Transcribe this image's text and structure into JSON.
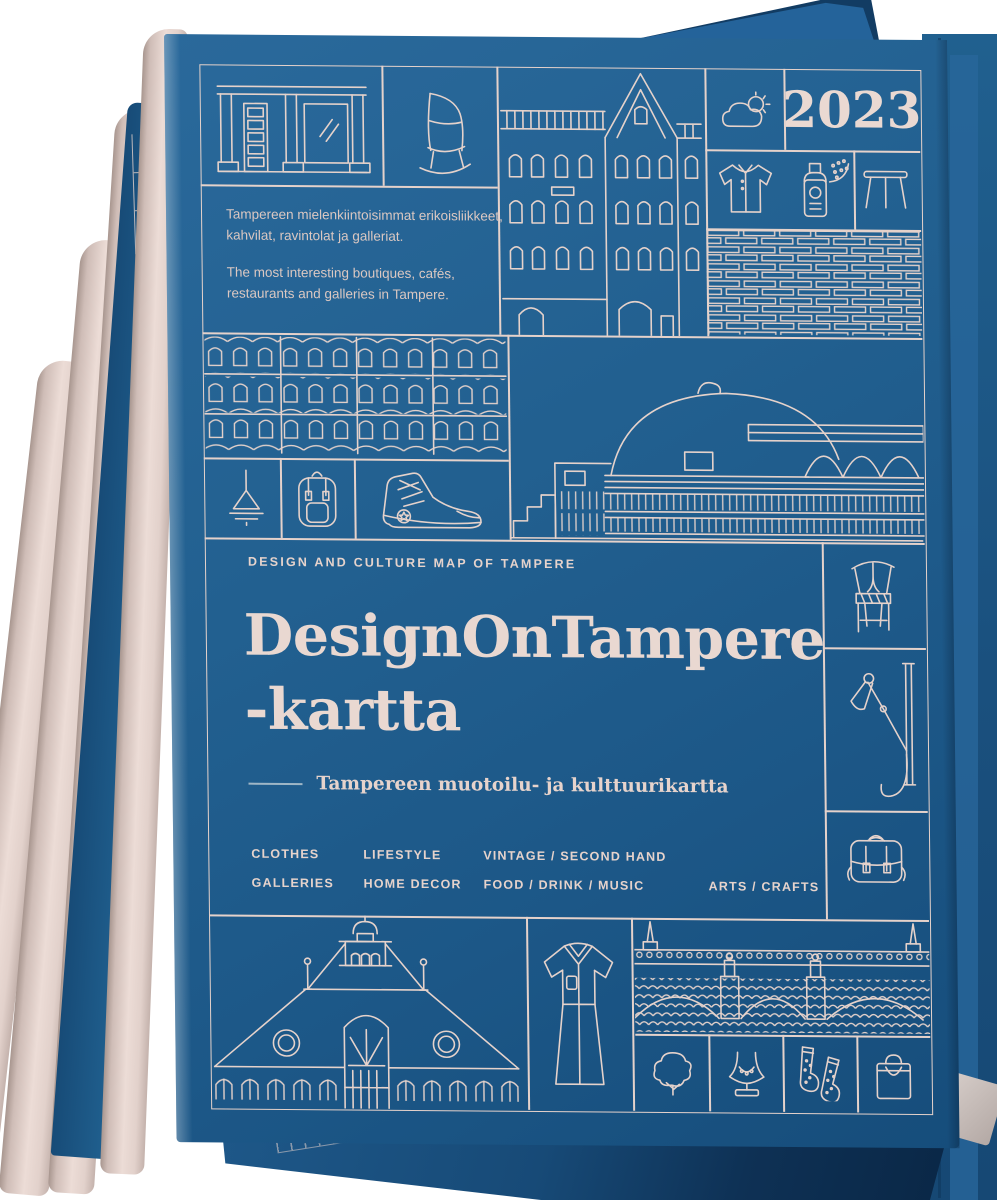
{
  "cover": {
    "year": "2023",
    "intro": {
      "fi": [
        "Tampereen mielenkiintoisimmat erikoisliikkeet,",
        "kahvilat, ravintolat ja galleriat."
      ],
      "en": [
        "The most interesting boutiques, cafés,",
        "restaurants and galleries in Tampere."
      ]
    },
    "masthead": {
      "eyebrow": "DESIGN AND CULTURE MAP OF TAMPERE",
      "title_line1": "DesignOnTampere",
      "title_line2": "-kartta",
      "subtitle": "Tampereen muotoilu- ja kulttuurikartta"
    },
    "categories": {
      "row1": [
        "CLOTHES",
        "LIFESTYLE",
        "VINTAGE / SECOND HAND"
      ],
      "row2": [
        "GALLERIES",
        "HOME DECOR",
        "FOOD / DRINK / MUSIC",
        "ARTS / CRAFTS"
      ]
    },
    "illustrations": [
      "storefront",
      "rocking-chair",
      "art-nouveau-facade",
      "cloud-sun-weather",
      "t-shirt",
      "spray-can",
      "side-table",
      "brick-wall",
      "factory-building",
      "pendant-lamp",
      "backpack",
      "sneaker",
      "arena-dome",
      "wishbone-chair",
      "wall-lamp",
      "satchel-bag",
      "market-hall",
      "dress",
      "bridge-and-waves",
      "tree",
      "necklace-stand",
      "socks",
      "shopping-bag"
    ]
  },
  "colors": {
    "cover_blue": "#226090",
    "line_cream": "#e5d2cb",
    "paper_cream": "#ecdcd6",
    "dark_navy": "#123c63"
  }
}
